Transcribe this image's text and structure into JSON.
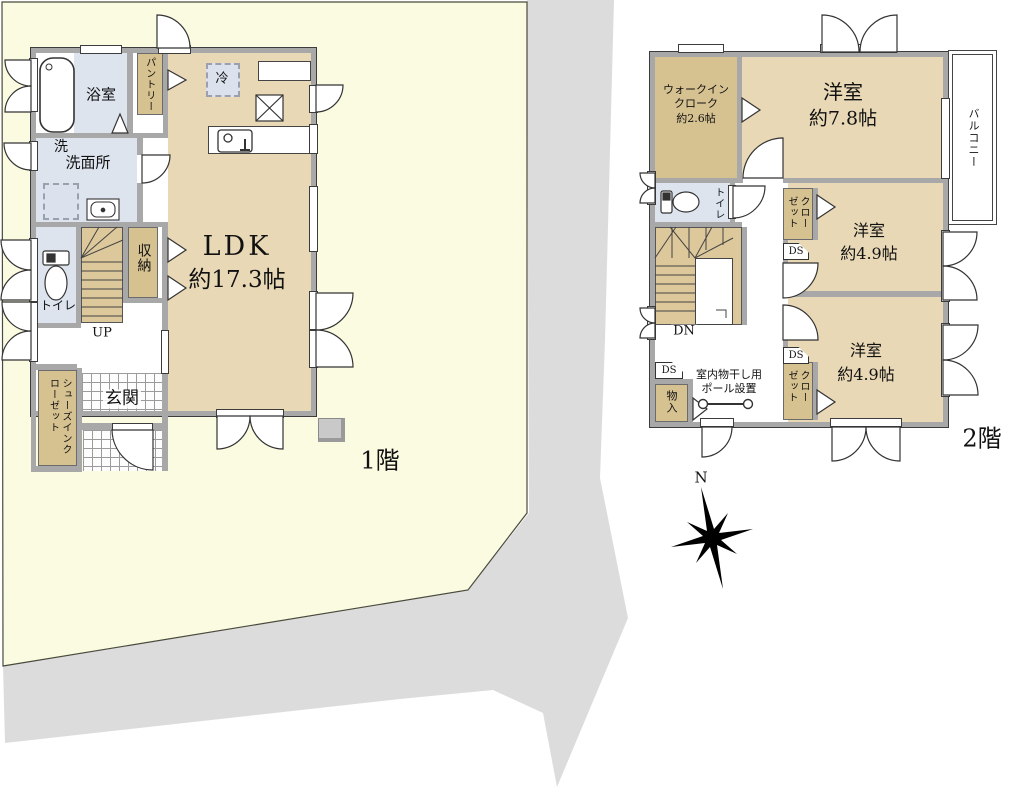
{
  "palette": {
    "plot": "#fbfbe2",
    "road": "#dcdcdc",
    "room_tan": "#e8d8b6",
    "closet_tan": "#d6c191",
    "stair_tan": "#ddc89c",
    "wet_blue": "#dde4ee",
    "wall_gray": "#a8a8a8"
  },
  "compass": {
    "n": "N"
  },
  "f1": {
    "floor_label": "1階",
    "bath": "浴室",
    "pantry": "パントリー",
    "fridge": "冷",
    "washroom": "洗面所",
    "washer": "洗",
    "toilet": "トイレ",
    "storage": "収納",
    "up": "UP",
    "ldk_name": "LDK",
    "ldk_size": "約17.3帖",
    "entrance": "玄関",
    "shoes_closet": "シューズインクローゼット"
  },
  "f2": {
    "floor_label": "2階",
    "wic_l1": "ウォークイン",
    "wic_l2": "クローク",
    "wic_size": "約2.6帖",
    "room78_name": "洋室",
    "room78_size": "約7.8帖",
    "balcony": "バルコニー",
    "toilet": "トイレ",
    "closet": "クローゼット",
    "ds": "DS",
    "room49_name": "洋室",
    "room49_size": "約4.9帖",
    "dn": "DN",
    "storage": "物入",
    "pole_l1": "室内物干し用",
    "pole_l2": "ポール設置"
  }
}
